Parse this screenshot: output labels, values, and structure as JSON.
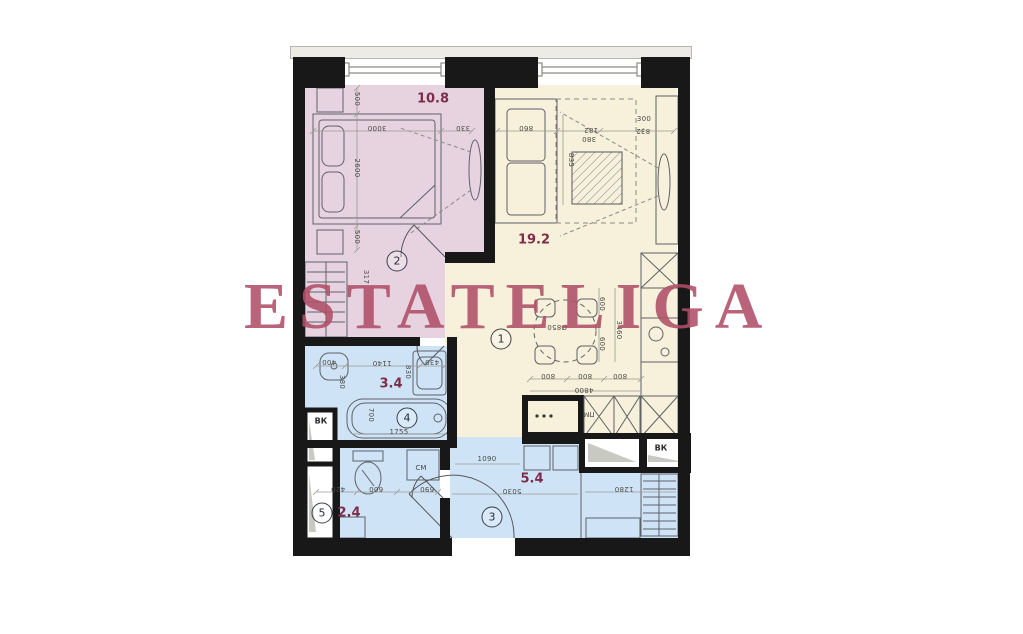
{
  "watermark": {
    "text": "ESTATELIGA",
    "color": "#b04f68"
  },
  "colors": {
    "wall": "#181818",
    "bedroom_fill": "#e7d3e0",
    "living_fill": "#f7f0da",
    "wet_fill": "#cfe3f6",
    "area_label": "#7e2d49",
    "watermark": "#b04f68"
  },
  "rooms": [
    {
      "number": "1",
      "area": "19.2"
    },
    {
      "number": "2",
      "area": "10.8"
    },
    {
      "number": "3",
      "area": "5.4"
    },
    {
      "number": "4",
      "area": "3.4"
    },
    {
      "number": "5",
      "area": "2.4"
    }
  ],
  "labels": [
    {
      "text": "10.8",
      "x": 433,
      "y": 99,
      "rot": 0,
      "kind": "area",
      "name": "area-bedroom"
    },
    {
      "text": "19.2",
      "x": 534,
      "y": 240,
      "rot": 0,
      "kind": "area",
      "name": "area-living"
    },
    {
      "text": "3.4",
      "x": 391,
      "y": 384,
      "rot": 0,
      "kind": "area",
      "name": "area-bathroom"
    },
    {
      "text": "2.4",
      "x": 349,
      "y": 513,
      "rot": 0,
      "kind": "area",
      "name": "area-wc"
    },
    {
      "text": "5.4",
      "x": 532,
      "y": 479,
      "rot": 0,
      "kind": "area",
      "name": "area-hall"
    },
    {
      "text": "2",
      "x": 397,
      "y": 261,
      "rot": 0,
      "kind": "circle",
      "name": "room-number-2"
    },
    {
      "text": "1",
      "x": 501,
      "y": 339,
      "rot": 0,
      "kind": "circle",
      "name": "room-number-1"
    },
    {
      "text": "4",
      "x": 407,
      "y": 418,
      "rot": 0,
      "kind": "circle",
      "name": "room-number-4"
    },
    {
      "text": "5",
      "x": 322,
      "y": 513,
      "rot": 0,
      "kind": "circle",
      "name": "room-number-5"
    },
    {
      "text": "3",
      "x": 492,
      "y": 517,
      "rot": 0,
      "kind": "circle",
      "name": "room-number-3"
    },
    {
      "text": "ВК",
      "x": 321,
      "y": 421,
      "rot": 0,
      "kind": "shaft",
      "name": "vent-shaft-left"
    },
    {
      "text": "ВК",
      "x": 661,
      "y": 448,
      "rot": 0,
      "kind": "shaft",
      "name": "vent-shaft-right"
    },
    {
      "text": "СМ",
      "x": 421,
      "y": 468,
      "rot": 0,
      "kind": "appl",
      "name": "washer-label"
    },
    {
      "text": "ПМ",
      "x": 589,
      "y": 414,
      "rot": 180,
      "kind": "appl",
      "name": "dishwasher-label"
    },
    {
      "text": "3000",
      "x": 377,
      "y": 128,
      "rot": 180,
      "kind": "dim",
      "name": "dim-3000"
    },
    {
      "text": "330",
      "x": 463,
      "y": 128,
      "rot": 180,
      "kind": "dim",
      "name": "dim-330"
    },
    {
      "text": "500",
      "x": 357,
      "y": 99,
      "rot": 90,
      "kind": "dim",
      "name": "dim-500-top"
    },
    {
      "text": "2600",
      "x": 357,
      "y": 168,
      "rot": 90,
      "kind": "dim",
      "name": "dim-2600"
    },
    {
      "text": "500",
      "x": 357,
      "y": 237,
      "rot": 90,
      "kind": "dim",
      "name": "dim-500-bottom"
    },
    {
      "text": "317",
      "x": 366,
      "y": 277,
      "rot": 90,
      "kind": "dim",
      "name": "dim-317"
    },
    {
      "text": "860",
      "x": 526,
      "y": 128,
      "rot": 180,
      "kind": "dim",
      "name": "dim-860"
    },
    {
      "text": "182",
      "x": 591,
      "y": 130,
      "rot": 180,
      "kind": "dim",
      "name": "dim-182"
    },
    {
      "text": "380",
      "x": 589,
      "y": 139,
      "rot": 180,
      "kind": "dim",
      "name": "dim-380"
    },
    {
      "text": "300",
      "x": 644,
      "y": 119,
      "rot": 0,
      "kind": "dim",
      "name": "dim-300"
    },
    {
      "text": "832",
      "x": 643,
      "y": 131,
      "rot": 180,
      "kind": "dim",
      "name": "dim-832"
    },
    {
      "text": "835",
      "x": 571,
      "y": 160,
      "rot": 90,
      "kind": "dim",
      "name": "dim-835"
    },
    {
      "text": "800",
      "x": 548,
      "y": 376,
      "rot": 180,
      "kind": "dim",
      "name": "dim-800-a"
    },
    {
      "text": "800",
      "x": 585,
      "y": 376,
      "rot": 180,
      "kind": "dim",
      "name": "dim-800-b"
    },
    {
      "text": "800",
      "x": 620,
      "y": 376,
      "rot": 180,
      "kind": "dim",
      "name": "dim-800-c"
    },
    {
      "text": "4800",
      "x": 584,
      "y": 390,
      "rot": 180,
      "kind": "dim",
      "name": "dim-4800"
    },
    {
      "text": "600",
      "x": 602,
      "y": 304,
      "rot": 90,
      "kind": "dim",
      "name": "dim-600-a"
    },
    {
      "text": "600",
      "x": 602,
      "y": 344,
      "rot": 90,
      "kind": "dim",
      "name": "dim-600-b"
    },
    {
      "text": "3460",
      "x": 619,
      "y": 330,
      "rot": 90,
      "kind": "dim",
      "name": "dim-3460"
    },
    {
      "text": "Ø850",
      "x": 557,
      "y": 327,
      "rot": 180,
      "kind": "dim",
      "name": "dim-table-diameter"
    },
    {
      "text": "400",
      "x": 329,
      "y": 362,
      "rot": 180,
      "kind": "dim",
      "name": "dim-400"
    },
    {
      "text": "1140",
      "x": 382,
      "y": 363,
      "rot": 180,
      "kind": "dim",
      "name": "dim-1140"
    },
    {
      "text": "430",
      "x": 432,
      "y": 362,
      "rot": 180,
      "kind": "dim",
      "name": "dim-430"
    },
    {
      "text": "830",
      "x": 408,
      "y": 372,
      "rot": 90,
      "kind": "dim",
      "name": "dim-830"
    },
    {
      "text": "380",
      "x": 342,
      "y": 382,
      "rot": 90,
      "kind": "dim",
      "name": "dim-380-basin"
    },
    {
      "text": "700",
      "x": 371,
      "y": 415,
      "rot": 90,
      "kind": "dim",
      "name": "dim-700"
    },
    {
      "text": "1755",
      "x": 399,
      "y": 432,
      "rot": 0,
      "kind": "dim",
      "name": "dim-1755"
    },
    {
      "text": "420",
      "x": 338,
      "y": 489,
      "rot": 180,
      "kind": "dim",
      "name": "dim-420"
    },
    {
      "text": "600",
      "x": 376,
      "y": 489,
      "rot": 180,
      "kind": "dim",
      "name": "dim-600-wc"
    },
    {
      "text": "690",
      "x": 427,
      "y": 489,
      "rot": 180,
      "kind": "dim",
      "name": "dim-690"
    },
    {
      "text": "1090",
      "x": 487,
      "y": 459,
      "rot": 0,
      "kind": "dim",
      "name": "dim-1090"
    },
    {
      "text": "5030",
      "x": 512,
      "y": 491,
      "rot": 180,
      "kind": "dim",
      "name": "dim-5030"
    },
    {
      "text": "1280",
      "x": 624,
      "y": 489,
      "rot": 180,
      "kind": "dim",
      "name": "dim-1280"
    }
  ]
}
